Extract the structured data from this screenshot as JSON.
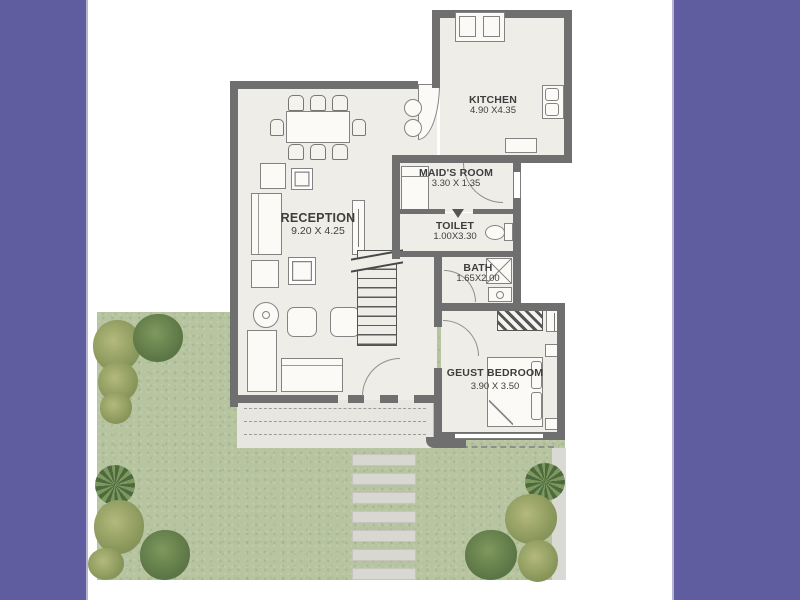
{
  "title": "apartment-ground-floor-plan",
  "colors": {
    "side_band": "#5f5c9f",
    "band_edge": "#b7b4cf",
    "wall": "#6f6f6f",
    "floor": "#efede8",
    "garden_grass": "#b7c4a0",
    "terrace": "#e7e6e1",
    "stepping_stone": "#d8d7d1",
    "label_text": "#3e3e3e"
  },
  "rooms": [
    {
      "id": "reception",
      "label": "RECEPTION",
      "dims": "9.20 X 4.25"
    },
    {
      "id": "kitchen",
      "label": "KITCHEN",
      "dims": "4.90 X4.35"
    },
    {
      "id": "maids_room",
      "label": "MAID'S ROOM",
      "dims": "3.30 X 1.35"
    },
    {
      "id": "toilet",
      "label": "TOILET",
      "dims": "1.00X3.30"
    },
    {
      "id": "bath",
      "label": "BATH",
      "dims": "1.65X2.00"
    },
    {
      "id": "guest_bedroom",
      "label": "GEUST BEDROOM",
      "dims": "3.90 X 3.50"
    }
  ],
  "fixtures": [
    "dining-table-with-8-chairs",
    "sofa-set",
    "armchairs",
    "floor-lamp",
    "tv-unit",
    "coffee-tables",
    "staircase",
    "stove-cooktop",
    "kitchen-double-sink",
    "kitchen-counter",
    "maids-bed",
    "wc-toilet",
    "shower-tray",
    "wash-basin",
    "wardrobe",
    "double-bed",
    "pillows",
    "nightstands",
    "terrace-pergola",
    "stepping-stones",
    "garden-shrubs",
    "garden-trees"
  ]
}
